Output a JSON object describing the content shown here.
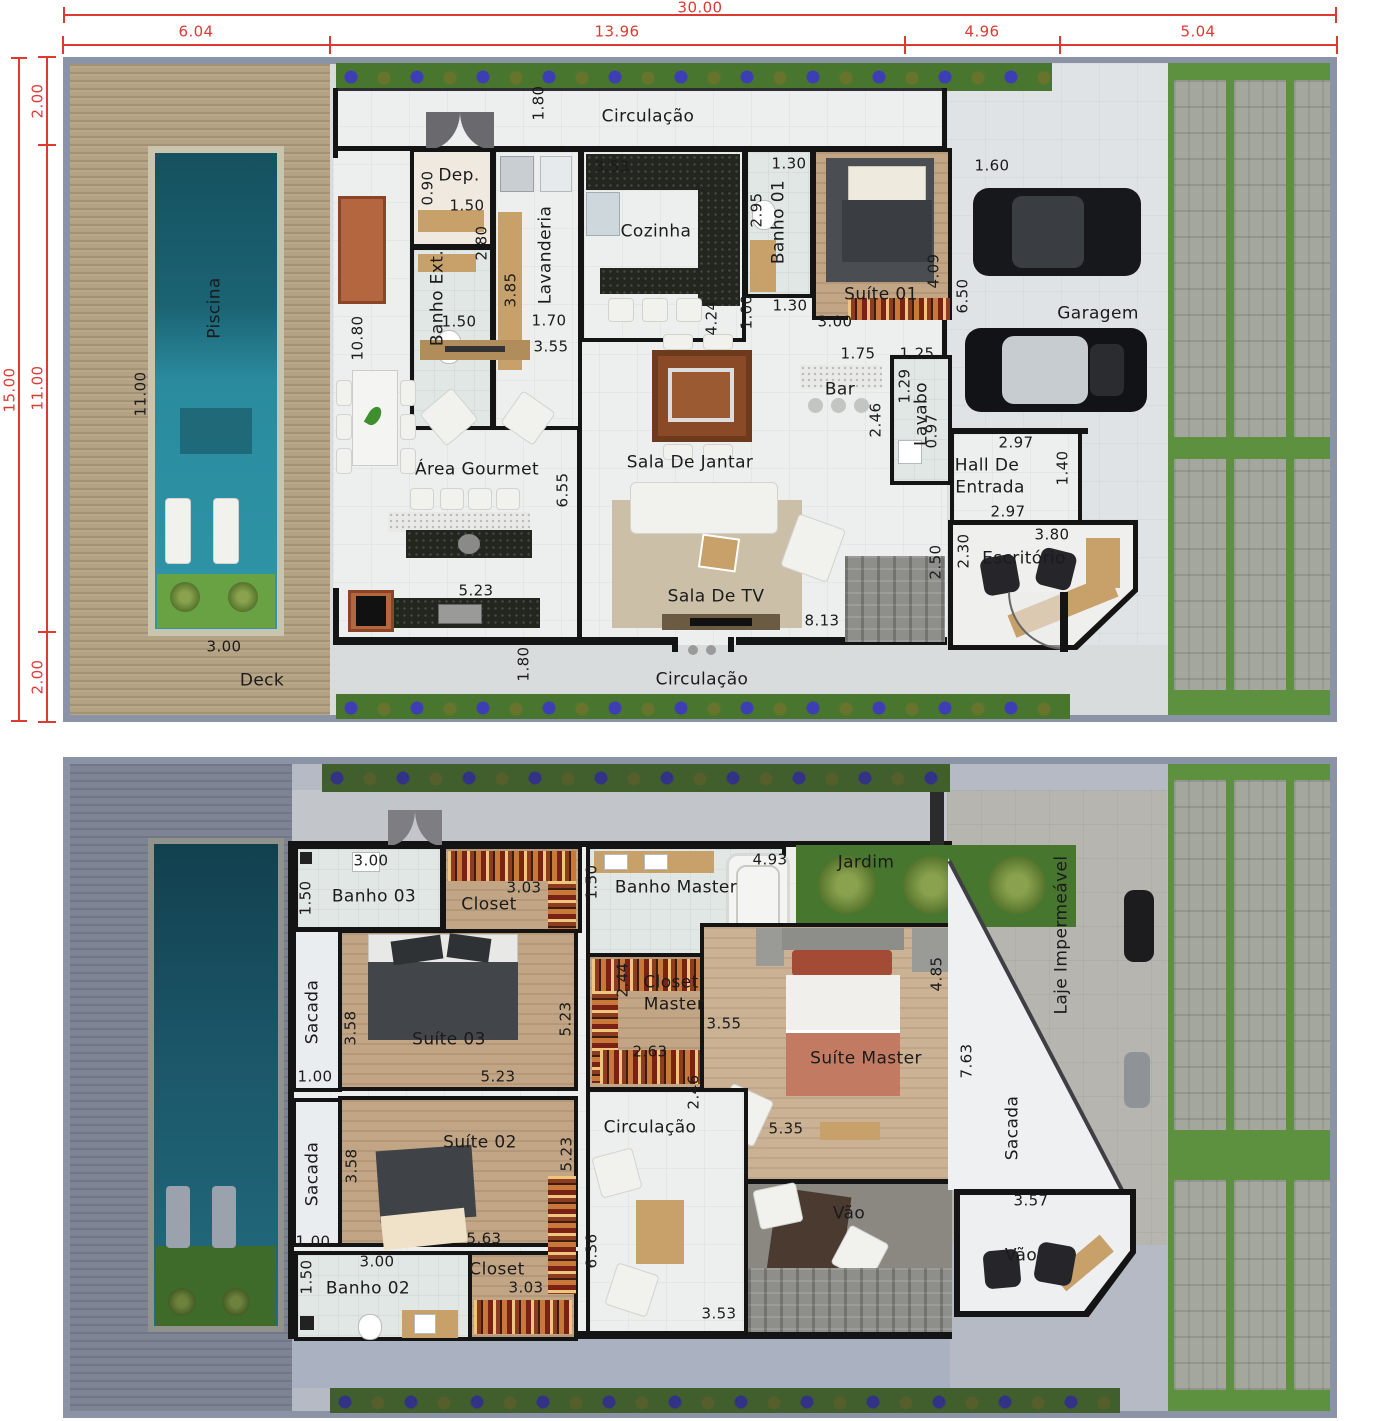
{
  "plan_title": "Two-storey house floor plan",
  "colors": {
    "dimension_red": "#dd3a32",
    "wall_black": "#141414",
    "label_dark": "#1b1b1b",
    "hedge_green": "#49762e",
    "lawn_green": "#5d9140",
    "pool_teal": "#2a8b9e",
    "wood_tan": "#c2a584"
  },
  "site_dimensions": {
    "top_total": "30.00",
    "top_segments": [
      "6.04",
      "13.96",
      "4.96",
      "5.04"
    ],
    "left_total": "15.00",
    "left_segments": [
      "2.00",
      "11.00",
      "2.00"
    ]
  },
  "red_labels": [
    {
      "t": "30.00",
      "x": 700,
      "y": 8
    },
    {
      "t": "6.04",
      "x": 196,
      "y": 32
    },
    {
      "t": "13.96",
      "x": 617,
      "y": 32
    },
    {
      "t": "4.96",
      "x": 982,
      "y": 32
    },
    {
      "t": "5.04",
      "x": 1198,
      "y": 32
    },
    {
      "t": "15.00",
      "x": 10,
      "y": 390,
      "v": 1
    },
    {
      "t": "2.00",
      "x": 38,
      "y": 101,
      "v": 1
    },
    {
      "t": "11.00",
      "x": 38,
      "y": 388,
      "v": 1
    },
    {
      "t": "2.00",
      "x": 38,
      "y": 677,
      "v": 1
    }
  ],
  "floor1": {
    "rooms": [
      {
        "t": "Circulação",
        "x": 648,
        "y": 117
      },
      {
        "t": "Dep.",
        "x": 459,
        "y": 176
      },
      {
        "t": "Banho Ext.",
        "x": 438,
        "y": 298,
        "v": 1
      },
      {
        "t": "Lavanderia",
        "x": 546,
        "y": 255,
        "v": 1
      },
      {
        "t": "Cozinha",
        "x": 656,
        "y": 232
      },
      {
        "t": "Banho 01",
        "x": 779,
        "y": 222,
        "v": 1
      },
      {
        "t": "Suíte 01",
        "x": 881,
        "y": 295
      },
      {
        "t": "Garagem",
        "x": 1098,
        "y": 314
      },
      {
        "t": "Bar",
        "x": 840,
        "y": 390
      },
      {
        "t": "Lavabo",
        "x": 922,
        "y": 414,
        "v": 1
      },
      {
        "t": "Hall De",
        "x": 987,
        "y": 466
      },
      {
        "t": "Entrada",
        "x": 990,
        "y": 488
      },
      {
        "t": "Escritório",
        "x": 1024,
        "y": 559
      },
      {
        "t": "Sala De Jantar",
        "x": 690,
        "y": 463
      },
      {
        "t": "Sala De TV",
        "x": 716,
        "y": 597
      },
      {
        "t": "Área Gourmet",
        "x": 477,
        "y": 470
      },
      {
        "t": "Piscina",
        "x": 215,
        "y": 308,
        "v": 1
      },
      {
        "t": "Deck",
        "x": 262,
        "y": 681
      },
      {
        "t": "Circulação",
        "x": 702,
        "y": 680
      }
    ],
    "measures": [
      {
        "t": "1.80",
        "x": 539,
        "y": 103,
        "v": 1
      },
      {
        "t": "0.90",
        "x": 428,
        "y": 188,
        "v": 1
      },
      {
        "t": "1.50",
        "x": 467,
        "y": 206
      },
      {
        "t": "3.53",
        "x": 612,
        "y": 167
      },
      {
        "t": "1.30",
        "x": 789,
        "y": 164
      },
      {
        "t": "2.95",
        "x": 757,
        "y": 210,
        "v": 1
      },
      {
        "t": "1.60",
        "x": 992,
        "y": 166
      },
      {
        "t": "2.80",
        "x": 482,
        "y": 243,
        "v": 1
      },
      {
        "t": "3.85",
        "x": 511,
        "y": 290,
        "v": 1
      },
      {
        "t": "1.70",
        "x": 549,
        "y": 321
      },
      {
        "t": "1.50",
        "x": 459,
        "y": 322
      },
      {
        "t": "4.09",
        "x": 934,
        "y": 271,
        "v": 1
      },
      {
        "t": "6.50",
        "x": 963,
        "y": 296,
        "v": 1
      },
      {
        "t": "3.00",
        "x": 835,
        "y": 322
      },
      {
        "t": "1.30",
        "x": 790,
        "y": 306
      },
      {
        "t": "1.00",
        "x": 747,
        "y": 312,
        "v": 1
      },
      {
        "t": "4.24",
        "x": 712,
        "y": 318,
        "v": 1
      },
      {
        "t": "10.80",
        "x": 358,
        "y": 338,
        "v": 1
      },
      {
        "t": "3.55",
        "x": 551,
        "y": 347
      },
      {
        "t": "1.75",
        "x": 858,
        "y": 354
      },
      {
        "t": "1.25",
        "x": 917,
        "y": 354
      },
      {
        "t": "1.29",
        "x": 905,
        "y": 386,
        "v": 1
      },
      {
        "t": "2.46",
        "x": 876,
        "y": 420,
        "v": 1
      },
      {
        "t": "0.97",
        "x": 932,
        "y": 431,
        "v": 1
      },
      {
        "t": "2.97",
        "x": 1016,
        "y": 443
      },
      {
        "t": "1.40",
        "x": 1063,
        "y": 468,
        "v": 1
      },
      {
        "t": "2.97",
        "x": 1008,
        "y": 512
      },
      {
        "t": "2.50",
        "x": 936,
        "y": 562,
        "v": 1
      },
      {
        "t": "2.30",
        "x": 964,
        "y": 551,
        "v": 1
      },
      {
        "t": "3.80",
        "x": 1052,
        "y": 535
      },
      {
        "t": "6.55",
        "x": 563,
        "y": 490,
        "v": 1
      },
      {
        "t": "5.23",
        "x": 476,
        "y": 591
      },
      {
        "t": "8.13",
        "x": 822,
        "y": 621
      },
      {
        "t": "1.80",
        "x": 524,
        "y": 664,
        "v": 1
      },
      {
        "t": "3.00",
        "x": 224,
        "y": 647
      },
      {
        "t": "11.00",
        "x": 141,
        "y": 394,
        "v": 1
      }
    ]
  },
  "floor2": {
    "rooms": [
      {
        "t": "Banho 03",
        "x": 374,
        "y": 897
      },
      {
        "t": "Closet",
        "x": 489,
        "y": 905
      },
      {
        "t": "Suíte 03",
        "x": 449,
        "y": 1040
      },
      {
        "t": "Sacada",
        "x": 313,
        "y": 1012,
        "v": 1
      },
      {
        "t": "Sacada",
        "x": 313,
        "y": 1174,
        "v": 1
      },
      {
        "t": "Banho Master",
        "x": 676,
        "y": 888
      },
      {
        "t": "Jardim",
        "x": 866,
        "y": 863
      },
      {
        "t": "Closet",
        "x": 671,
        "y": 983
      },
      {
        "t": "Master",
        "x": 674,
        "y": 1005
      },
      {
        "t": "Suíte Master",
        "x": 866,
        "y": 1059
      },
      {
        "t": "Circulação",
        "x": 650,
        "y": 1128
      },
      {
        "t": "Suíte 02",
        "x": 480,
        "y": 1143
      },
      {
        "t": "Banho 02",
        "x": 368,
        "y": 1289
      },
      {
        "t": "Closet",
        "x": 497,
        "y": 1270
      },
      {
        "t": "Vão",
        "x": 849,
        "y": 1214
      },
      {
        "t": "Vão",
        "x": 1021,
        "y": 1256
      },
      {
        "t": "Sacada",
        "x": 1013,
        "y": 1128,
        "v": 1
      },
      {
        "t": "Laje Impermeável",
        "x": 1062,
        "y": 935,
        "v": 1
      }
    ],
    "measures": [
      {
        "t": "3.00",
        "x": 371,
        "y": 861
      },
      {
        "t": "1.50",
        "x": 306,
        "y": 898,
        "v": 1
      },
      {
        "t": "3.03",
        "x": 524,
        "y": 888
      },
      {
        "t": "1.50",
        "x": 592,
        "y": 882,
        "v": 1
      },
      {
        "t": "4.93",
        "x": 770,
        "y": 860
      },
      {
        "t": "2.44",
        "x": 623,
        "y": 980,
        "v": 1
      },
      {
        "t": "3.55",
        "x": 724,
        "y": 1024
      },
      {
        "t": "2.63",
        "x": 650,
        "y": 1052
      },
      {
        "t": "4.85",
        "x": 937,
        "y": 974,
        "v": 1
      },
      {
        "t": "7.63",
        "x": 967,
        "y": 1061,
        "v": 1
      },
      {
        "t": "3.58",
        "x": 351,
        "y": 1028,
        "v": 1
      },
      {
        "t": "5.23",
        "x": 566,
        "y": 1019,
        "v": 1
      },
      {
        "t": "1.00",
        "x": 315,
        "y": 1077
      },
      {
        "t": "5.23",
        "x": 498,
        "y": 1077
      },
      {
        "t": "2.46",
        "x": 694,
        "y": 1092,
        "v": 1
      },
      {
        "t": "5.35",
        "x": 786,
        "y": 1129
      },
      {
        "t": "3.58",
        "x": 352,
        "y": 1166,
        "v": 1
      },
      {
        "t": "5.23",
        "x": 567,
        "y": 1154,
        "v": 1
      },
      {
        "t": "1.00",
        "x": 313,
        "y": 1242
      },
      {
        "t": "5.63",
        "x": 484,
        "y": 1239
      },
      {
        "t": "3.00",
        "x": 377,
        "y": 1262
      },
      {
        "t": "1.50",
        "x": 307,
        "y": 1277,
        "v": 1
      },
      {
        "t": "3.03",
        "x": 526,
        "y": 1288
      },
      {
        "t": "6.36",
        "x": 592,
        "y": 1251,
        "v": 1
      },
      {
        "t": "3.53",
        "x": 719,
        "y": 1314
      },
      {
        "t": "3.57",
        "x": 1031,
        "y": 1201
      }
    ]
  },
  "dimension_lines": {
    "top_total_line": {
      "x1": 63,
      "x2": 1337,
      "y": 14
    },
    "top_segment_line": {
      "x1": 63,
      "x2": 1337,
      "y": 44,
      "ticks": [
        63,
        330,
        905,
        1060,
        1337
      ]
    },
    "left_total_line": {
      "y1": 57,
      "y2": 722,
      "x": 18
    },
    "left_segment_line": {
      "y1": 57,
      "y2": 722,
      "x": 46,
      "ticks": [
        57,
        145,
        632,
        722
      ]
    }
  }
}
